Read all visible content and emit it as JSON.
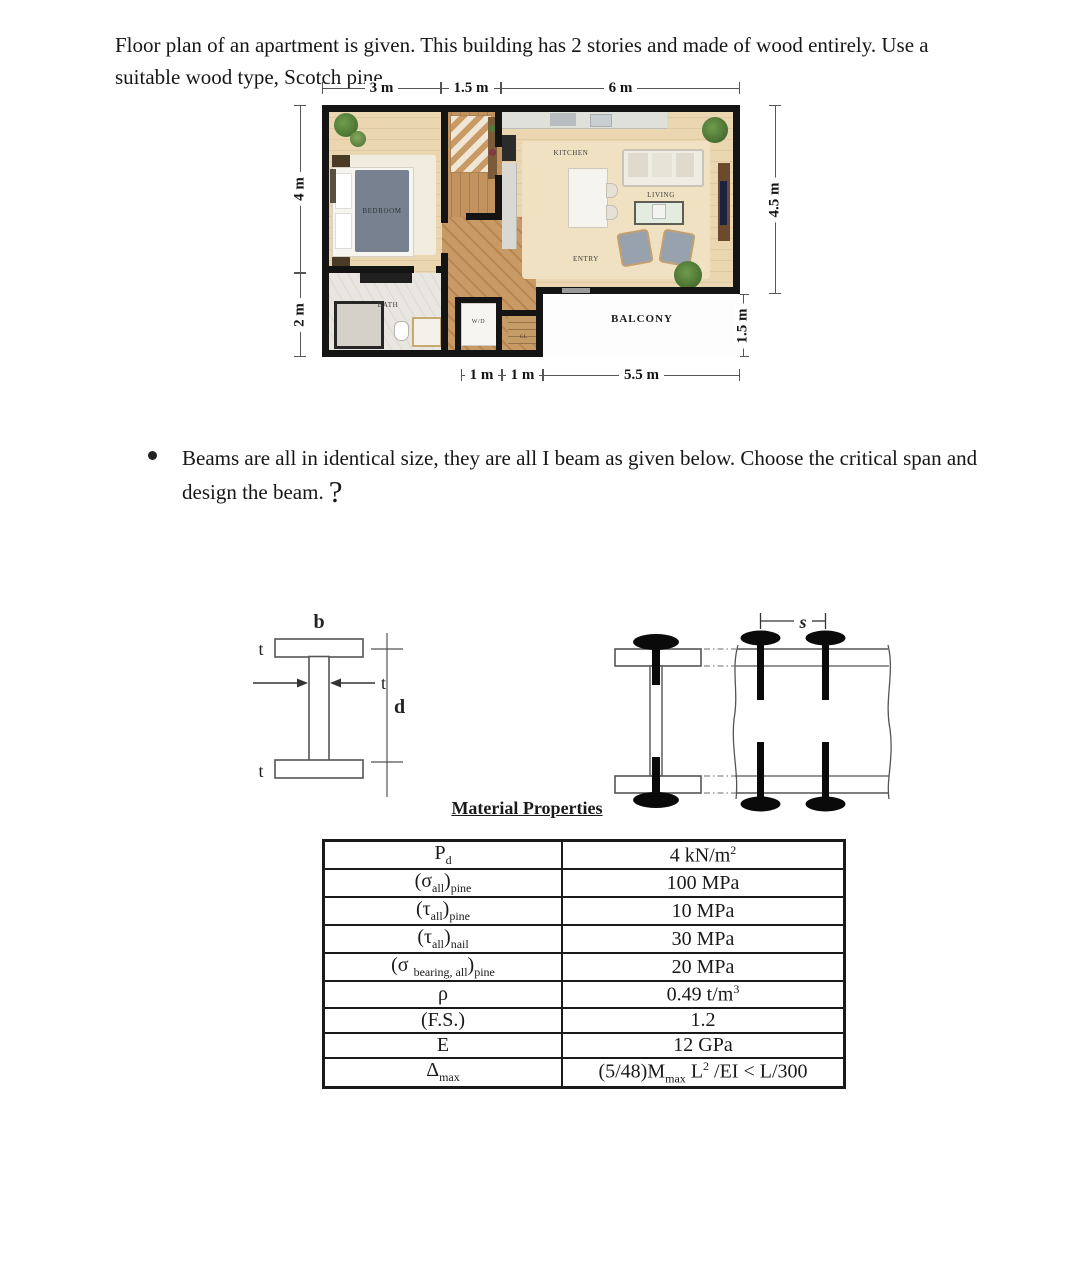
{
  "intro": "Floor plan of an apartment is given. This building has 2 stories and made of wood entirely. Use a suitable wood type, Scotch pine.",
  "bullet": {
    "text": "Beams are all in identical size, they are all I beam as given below. Choose the critical span and design the beam.",
    "question_mark": "?"
  },
  "floorplan": {
    "dimensions": {
      "top": [
        "3 m",
        "1.5 m",
        "6 m"
      ],
      "left": [
        "4 m",
        "2 m"
      ],
      "right": [
        "4.5 m",
        "1.5 m"
      ],
      "bottom": [
        "1 m",
        "1 m",
        "5.5 m"
      ]
    },
    "labels": {
      "bedroom": "BEDROOM",
      "bath": "BATH",
      "kitchen": "KITCHEN",
      "living": "LIVING",
      "entry": "ENTRY",
      "wd": "W/D",
      "cl": "CL",
      "balcony": "BALCONY"
    }
  },
  "beam": {
    "flange_width": "b",
    "flange_thickness_top": "t",
    "web_thickness": "t",
    "flange_thickness_bottom": "t",
    "depth": "d",
    "nail_spacing": "s"
  },
  "material_table": {
    "title": "Material Properties",
    "rows": [
      {
        "label": "P<sub>d</sub>",
        "value": "4 kN/m<sup>2</sup>"
      },
      {
        "label": "(σ<sub>all</sub>)<sub>pine</sub>",
        "value": "100 MPa"
      },
      {
        "label": "(τ<sub>all</sub>)<sub>pine</sub>",
        "value": "10 MPa"
      },
      {
        "label": "(τ<sub>all</sub>)<sub>nail</sub>",
        "value": "30 MPa"
      },
      {
        "label": "(σ <sub>bearing, all</sub>)<sub>pine</sub>",
        "value": "20 MPa"
      },
      {
        "label": "ρ",
        "value": "0.49 t/m<sup>3</sup>"
      },
      {
        "label": "(F.S.)",
        "value": "1.2"
      },
      {
        "label": "E",
        "value": "12 GPa"
      },
      {
        "label": "Δ<sub>max</sub>",
        "value": "(5/48)M<sub>max</sub> L<sup>2</sup> /EI &lt; L/300"
      }
    ]
  },
  "colors": {
    "wall": "#141414",
    "wood_floor": "#ead7b2",
    "hall_wood": "#c2935f",
    "bath_floor": "#e9e6e1",
    "bed_blanket": "#77818f",
    "chair_gray": "#98a2ae",
    "plant_green": "#4e7c3a"
  }
}
